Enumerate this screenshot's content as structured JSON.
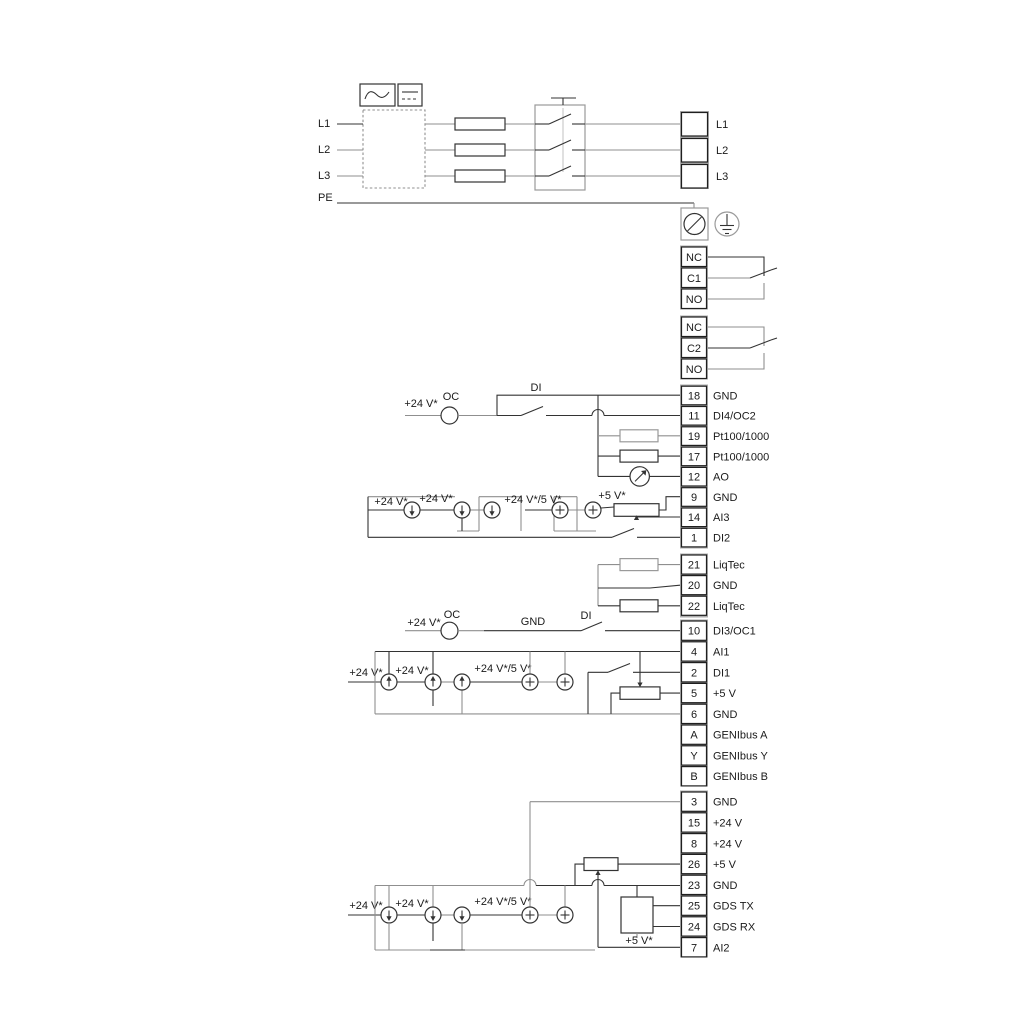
{
  "title": "Pump drive wiring diagram",
  "colors": {
    "wire_gray": "#8f8f8f",
    "wire_black": "#333333",
    "terminal_gap": "#ababab"
  },
  "power": {
    "phase_inputs": [
      "L1",
      "L2",
      "L3"
    ],
    "pe_label": "PE",
    "output_terminals": [
      "L1",
      "L2",
      "L3"
    ]
  },
  "relays": {
    "relay1": [
      "NC",
      "C1",
      "NO"
    ],
    "relay2": [
      "NC",
      "C2",
      "NO"
    ]
  },
  "strips": {
    "io1": [
      {
        "id": "18",
        "label": "GND"
      },
      {
        "id": "11",
        "label": "DI4/OC2"
      },
      {
        "id": "19",
        "label": "Pt100/1000"
      },
      {
        "id": "17",
        "label": "Pt100/1000"
      },
      {
        "id": "12",
        "label": "AO"
      },
      {
        "id": "9",
        "label": "GND"
      },
      {
        "id": "14",
        "label": "AI3"
      },
      {
        "id": "1",
        "label": "DI2"
      }
    ],
    "liqtec": [
      {
        "id": "21",
        "label": "LiqTec"
      },
      {
        "id": "20",
        "label": "GND"
      },
      {
        "id": "22",
        "label": "LiqTec"
      }
    ],
    "io2": [
      {
        "id": "10",
        "label": "DI3/OC1"
      },
      {
        "id": "4",
        "label": "AI1"
      },
      {
        "id": "2",
        "label": "DI1"
      },
      {
        "id": "5",
        "label": "+5 V"
      },
      {
        "id": "6",
        "label": "GND"
      },
      {
        "id": "A",
        "label": "GENIbus A"
      },
      {
        "id": "Y",
        "label": "GENIbus Y"
      },
      {
        "id": "B",
        "label": "GENIbus B"
      }
    ],
    "io3": [
      {
        "id": "3",
        "label": "GND"
      },
      {
        "id": "15",
        "label": "+24 V"
      },
      {
        "id": "8",
        "label": "+24 V"
      },
      {
        "id": "26",
        "label": "+5 V"
      },
      {
        "id": "23",
        "label": "GND"
      },
      {
        "id": "25",
        "label": "GDS TX"
      },
      {
        "id": "24",
        "label": "GDS RX"
      },
      {
        "id": "7",
        "label": "AI2"
      }
    ]
  },
  "wire_labels": {
    "v24": "+24 V*",
    "v24_5": "+24 V*/5 V*",
    "v5": "+5 V*",
    "oc": "OC",
    "di": "DI",
    "gnd": "GND"
  }
}
